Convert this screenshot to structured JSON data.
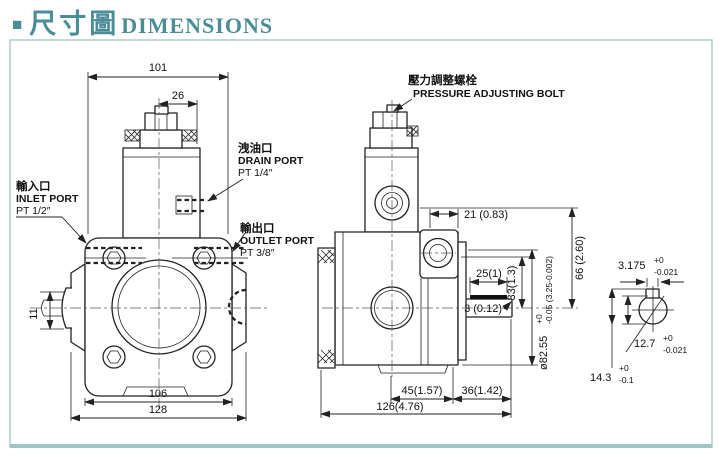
{
  "header": {
    "bullet": "■",
    "title_zh": "尺寸圖",
    "title_en": "DIMENSIONS"
  },
  "colors": {
    "accent_teal": "#4a8d99",
    "frame_border": "#a9c9c7",
    "line": "#222222"
  },
  "front_view": {
    "dim_width_top": "101",
    "dim_cap": "26",
    "dim_bolt_span": "106",
    "dim_total_width": "128",
    "dim_shaft": "11",
    "drain_port": {
      "zh": "洩油口",
      "en": "DRAIN PORT",
      "size": "PT 1/4″"
    },
    "inlet_port": {
      "zh": "輸入口",
      "en": "INLET PORT",
      "size": "PT 1/2″"
    },
    "outlet_port": {
      "zh": "輸出口",
      "en": "OUTLET PORT",
      "size": "PT 3/8″"
    }
  },
  "side_view": {
    "pressure_bolt": {
      "zh": "壓力調整螺栓",
      "en": "PRESSURE ADJUSTING BOLT"
    },
    "dim_21": "21 (0.83)",
    "dim_25": "25(1)",
    "dim_3": "3 (0.12)",
    "dim_33": "33(1.3)",
    "dim_66": "66 (2.60)",
    "dim_dia": "ø82.55",
    "dia_tol_top": "+0",
    "dia_tol_bottom": "-0.05 (3.25-0.002)",
    "dim_45": "45(1.57)",
    "dim_36": "36(1.42)",
    "dim_126": "126(4.76)"
  },
  "shaft_detail": {
    "key_width": "3.175",
    "key_tol_top": "+0",
    "key_tol_bottom": "-0.021",
    "shaft_dia": "12.7",
    "dia_tol_top": "+0",
    "dia_tol_bottom": "-0.021",
    "overall": "14.3",
    "overall_tol_top": "+0",
    "overall_tol_bottom": "-0.1"
  }
}
